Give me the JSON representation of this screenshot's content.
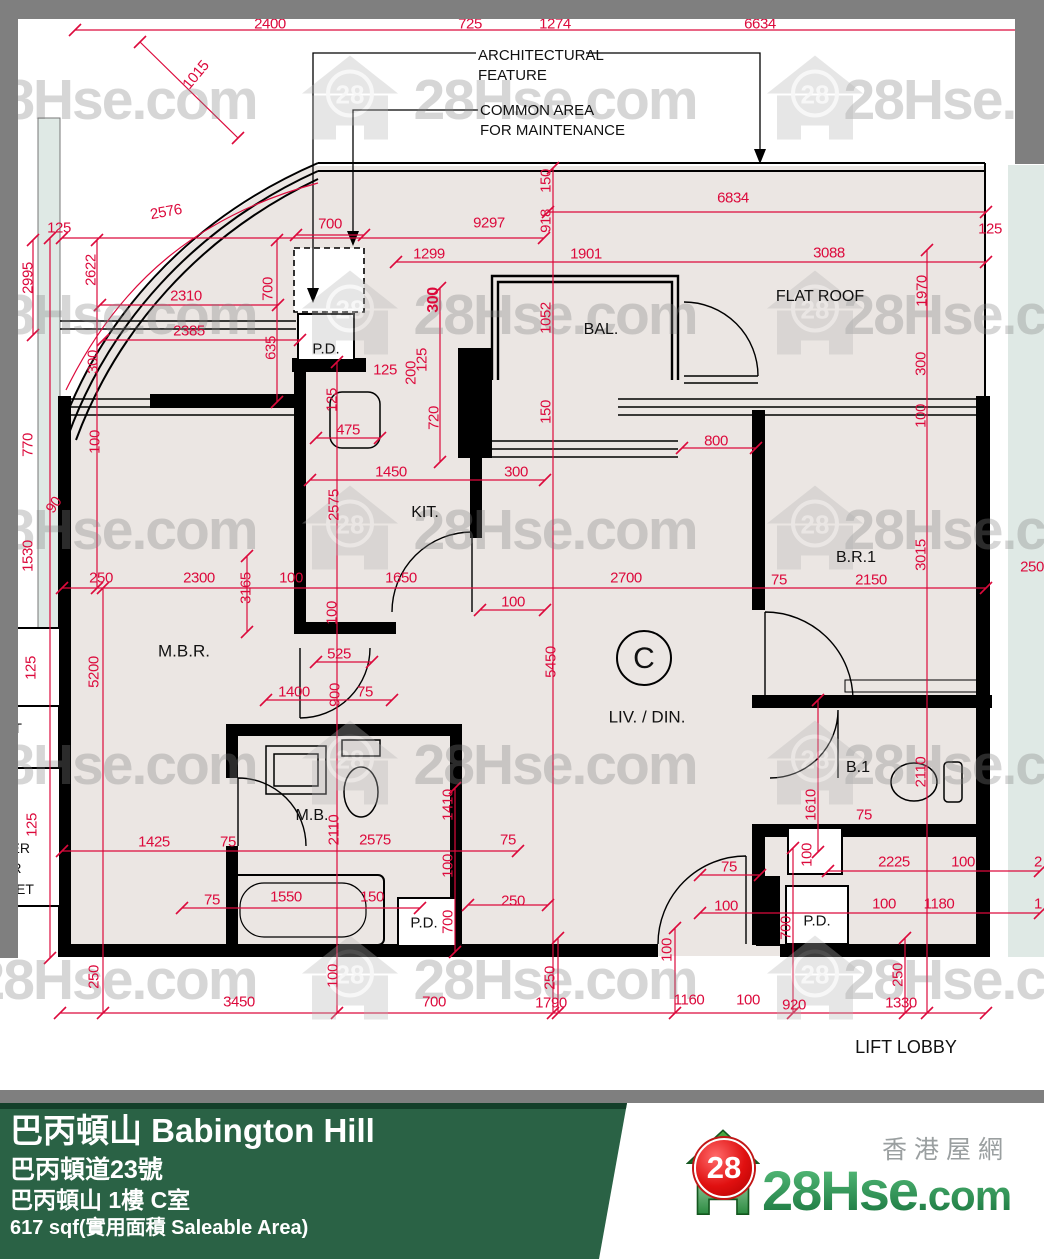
{
  "plan": {
    "red_color": "#dc0a3c",
    "dims": [
      [
        "2400",
        270,
        24,
        0
      ],
      [
        "725",
        470,
        24,
        0
      ],
      [
        "1274",
        555,
        24,
        0
      ],
      [
        "6634",
        760,
        24,
        0
      ],
      [
        "1015",
        196,
        75,
        -50
      ],
      [
        "2576",
        166,
        212,
        -10
      ],
      [
        "125",
        59,
        228,
        0
      ],
      [
        "700",
        330,
        224,
        0
      ],
      [
        "9297",
        489,
        223,
        0
      ],
      [
        "6834",
        733,
        198,
        0
      ],
      [
        "125",
        990,
        229,
        0
      ],
      [
        "2995",
        28,
        278,
        -90
      ],
      [
        "2622",
        91,
        270,
        -90
      ],
      [
        "918",
        546,
        221,
        -90
      ],
      [
        "150",
        546,
        181,
        -90
      ],
      [
        "1299",
        429,
        254,
        0
      ],
      [
        "1901",
        586,
        254,
        0
      ],
      [
        "3088",
        829,
        253,
        0
      ],
      [
        "2310",
        186,
        296,
        0
      ],
      [
        "2385",
        189,
        331,
        0
      ],
      [
        "700",
        268,
        289,
        -90
      ],
      [
        "635",
        271,
        348,
        -90
      ],
      [
        "1970",
        922,
        291,
        -90
      ],
      [
        "300",
        93,
        362,
        -90
      ],
      [
        "100",
        95,
        442,
        -90
      ],
      [
        "770",
        28,
        445,
        -90
      ],
      [
        "90",
        54,
        505,
        -55
      ],
      [
        "1530",
        28,
        556,
        -90
      ],
      [
        "125",
        31,
        668,
        -90
      ],
      [
        "125",
        32,
        825,
        -90
      ],
      [
        "125",
        385,
        370,
        0
      ],
      [
        "125",
        332,
        400,
        -90
      ],
      [
        "475",
        348,
        430,
        0
      ],
      [
        "200",
        411,
        373,
        -90
      ],
      [
        "125",
        422,
        360,
        -90
      ],
      [
        "300",
        434,
        300,
        -90,
        "b"
      ],
      [
        "720",
        434,
        418,
        -90
      ],
      [
        "1052",
        546,
        318,
        -90
      ],
      [
        "150",
        546,
        412,
        -90
      ],
      [
        "800",
        716,
        441,
        0
      ],
      [
        "300",
        921,
        364,
        -90
      ],
      [
        "100",
        921,
        416,
        -90
      ],
      [
        "1450",
        391,
        472,
        0
      ],
      [
        "300",
        516,
        472,
        0
      ],
      [
        "2575",
        334,
        505,
        -90
      ],
      [
        "250",
        101,
        578,
        0
      ],
      [
        "2300",
        199,
        578,
        0
      ],
      [
        "3165",
        246,
        588,
        -90
      ],
      [
        "100",
        291,
        578,
        0
      ],
      [
        "1650",
        401,
        578,
        0
      ],
      [
        "100",
        513,
        602,
        0
      ],
      [
        "2700",
        626,
        578,
        0
      ],
      [
        "75",
        779,
        580,
        0
      ],
      [
        "2150",
        871,
        580,
        0
      ],
      [
        "3015",
        921,
        555,
        -90
      ],
      [
        "250",
        1032,
        567,
        0
      ],
      [
        "5200",
        94,
        672,
        -90
      ],
      [
        "5450",
        551,
        662,
        -90
      ],
      [
        "100",
        332,
        613,
        -90
      ],
      [
        "525",
        339,
        654,
        0
      ],
      [
        "1400",
        294,
        692,
        0
      ],
      [
        "900",
        335,
        695,
        -90
      ],
      [
        "75",
        365,
        692,
        0
      ],
      [
        "1610",
        811,
        805,
        -90
      ],
      [
        "2110",
        921,
        772,
        -90
      ],
      [
        "75",
        864,
        815,
        0
      ],
      [
        "100",
        807,
        855,
        -90
      ],
      [
        "2110",
        334,
        830,
        -90
      ],
      [
        "2575",
        375,
        840,
        0
      ],
      [
        "1410",
        448,
        805,
        -90
      ],
      [
        "100",
        448,
        866,
        -90
      ],
      [
        "1425",
        154,
        842,
        0
      ],
      [
        "75",
        228,
        842,
        0
      ],
      [
        "75",
        508,
        840,
        0
      ],
      [
        "75",
        212,
        900,
        0
      ],
      [
        "1550",
        286,
        897,
        0
      ],
      [
        "150",
        372,
        897,
        0
      ],
      [
        "250",
        513,
        901,
        0
      ],
      [
        "2225",
        894,
        862,
        0
      ],
      [
        "100",
        963,
        862,
        0
      ],
      [
        "2",
        1038,
        862,
        0
      ],
      [
        "100",
        884,
        904,
        0
      ],
      [
        "1180",
        939,
        904,
        0
      ],
      [
        "1",
        1038,
        904,
        0
      ],
      [
        "700",
        448,
        922,
        -90
      ],
      [
        "700",
        786,
        928,
        -90
      ],
      [
        "75",
        729,
        867,
        0
      ],
      [
        "100",
        726,
        906,
        0
      ],
      [
        "100",
        667,
        950,
        -90
      ],
      [
        "250",
        94,
        977,
        -90
      ],
      [
        "100",
        333,
        976,
        -90
      ],
      [
        "250",
        550,
        978,
        -90
      ],
      [
        "250",
        898,
        975,
        -90
      ],
      [
        "3450",
        239,
        1002,
        0
      ],
      [
        "700",
        434,
        1002,
        0
      ],
      [
        "1790",
        551,
        1003,
        0
      ],
      [
        "1160",
        689,
        1000,
        0
      ],
      [
        "100",
        748,
        1000,
        0
      ],
      [
        "920",
        794,
        1005,
        0
      ],
      [
        "1330",
        901,
        1003,
        0
      ]
    ],
    "rooms": [
      [
        "P.D.",
        326,
        349,
        15
      ],
      [
        "BAL.",
        601,
        330,
        16
      ],
      [
        "FLAT ROOF",
        820,
        297,
        16
      ],
      [
        "KIT.",
        425,
        513,
        16
      ],
      [
        "M.B.R.",
        184,
        651,
        17
      ],
      [
        "C",
        644,
        659,
        30
      ],
      [
        "LIV. / DIN.",
        647,
        717,
        17
      ],
      [
        "M.B.",
        312,
        816,
        16
      ],
      [
        "B.R.1",
        856,
        558,
        16
      ],
      [
        "B.1",
        858,
        768,
        16
      ],
      [
        "P.D.",
        424,
        923,
        15
      ],
      [
        "P.D.",
        817,
        921,
        15
      ],
      [
        "LIFT LOBBY",
        906,
        1047,
        18
      ]
    ],
    "callouts": [
      {
        "lines": [
          "ARCHITECTURAL",
          "FEATURE"
        ],
        "x": 478,
        "y": 46
      },
      {
        "lines": [
          "COMMON AREA",
          "FOR MAINTENANCE"
        ],
        "x": 480,
        "y": 101
      }
    ],
    "edge_fragments": [
      [
        "T",
        4,
        706
      ],
      [
        "ET",
        4,
        721
      ],
      [
        "TER",
        2,
        841
      ],
      [
        "ER",
        2,
        861
      ],
      [
        "INET",
        2,
        882
      ]
    ],
    "watermark_text": "28Hse.com",
    "watermark_texts_xy": [
      [
        115,
        100
      ],
      [
        555,
        100
      ],
      [
        985,
        100
      ],
      [
        115,
        315
      ],
      [
        555,
        315
      ],
      [
        985,
        315
      ],
      [
        115,
        530
      ],
      [
        555,
        530
      ],
      [
        985,
        530
      ],
      [
        115,
        765
      ],
      [
        555,
        765
      ],
      [
        985,
        765
      ],
      [
        115,
        980
      ],
      [
        555,
        980
      ],
      [
        985,
        980
      ]
    ],
    "watermark_houses_xy": [
      [
        350,
        100
      ],
      [
        815,
        100
      ],
      [
        350,
        315
      ],
      [
        815,
        315
      ],
      [
        350,
        530
      ],
      [
        815,
        530
      ],
      [
        350,
        765
      ],
      [
        815,
        765
      ],
      [
        350,
        980
      ],
      [
        815,
        980
      ]
    ],
    "red_lines": [
      [
        75,
        30,
        1040,
        30
      ],
      [
        548,
        212,
        986,
        212
      ],
      [
        62,
        238,
        544,
        238
      ],
      [
        396,
        262,
        986,
        262
      ],
      [
        100,
        305,
        278,
        305
      ],
      [
        103,
        340,
        300,
        340
      ],
      [
        296,
        235,
        364,
        235
      ],
      [
        316,
        438,
        380,
        438
      ],
      [
        310,
        480,
        545,
        480
      ],
      [
        682,
        448,
        756,
        448
      ],
      [
        480,
        610,
        545,
        610
      ],
      [
        62,
        588,
        986,
        588
      ],
      [
        266,
        700,
        392,
        700
      ],
      [
        316,
        662,
        372,
        662
      ],
      [
        62,
        851,
        518,
        851
      ],
      [
        182,
        908,
        420,
        908
      ],
      [
        468,
        905,
        548,
        905
      ],
      [
        828,
        871,
        1040,
        871
      ],
      [
        700,
        913,
        1040,
        913
      ],
      [
        60,
        1013,
        986,
        1013
      ],
      [
        700,
        875,
        760,
        875
      ],
      [
        50,
        238,
        50,
        958
      ],
      [
        33,
        240,
        33,
        335
      ],
      [
        97,
        240,
        97,
        588
      ],
      [
        277,
        240,
        277,
        402
      ],
      [
        337,
        362,
        337,
        1013
      ],
      [
        440,
        288,
        440,
        462
      ],
      [
        553,
        168,
        553,
        1013
      ],
      [
        103,
        588,
        103,
        1013
      ],
      [
        247,
        556,
        247,
        632
      ],
      [
        455,
        788,
        455,
        952
      ],
      [
        675,
        928,
        675,
        1013
      ],
      [
        793,
        848,
        793,
        1013
      ],
      [
        818,
        700,
        818,
        852
      ],
      [
        927,
        250,
        927,
        1013
      ],
      [
        558,
        938,
        558,
        1013
      ],
      [
        905,
        938,
        905,
        1013
      ],
      [
        140,
        42,
        238,
        138
      ]
    ]
  },
  "banner": {
    "title": "巴丙頓山 Babington Hill",
    "address": "巴丙頓道23號",
    "unit": "巴丙頓山 1樓 C室",
    "area": "617 sqf(實用面積 Saleable Area)"
  },
  "logo": {
    "badge": "28",
    "site": "28Hse",
    "tld": ".com",
    "tagline": "香港屋網"
  }
}
